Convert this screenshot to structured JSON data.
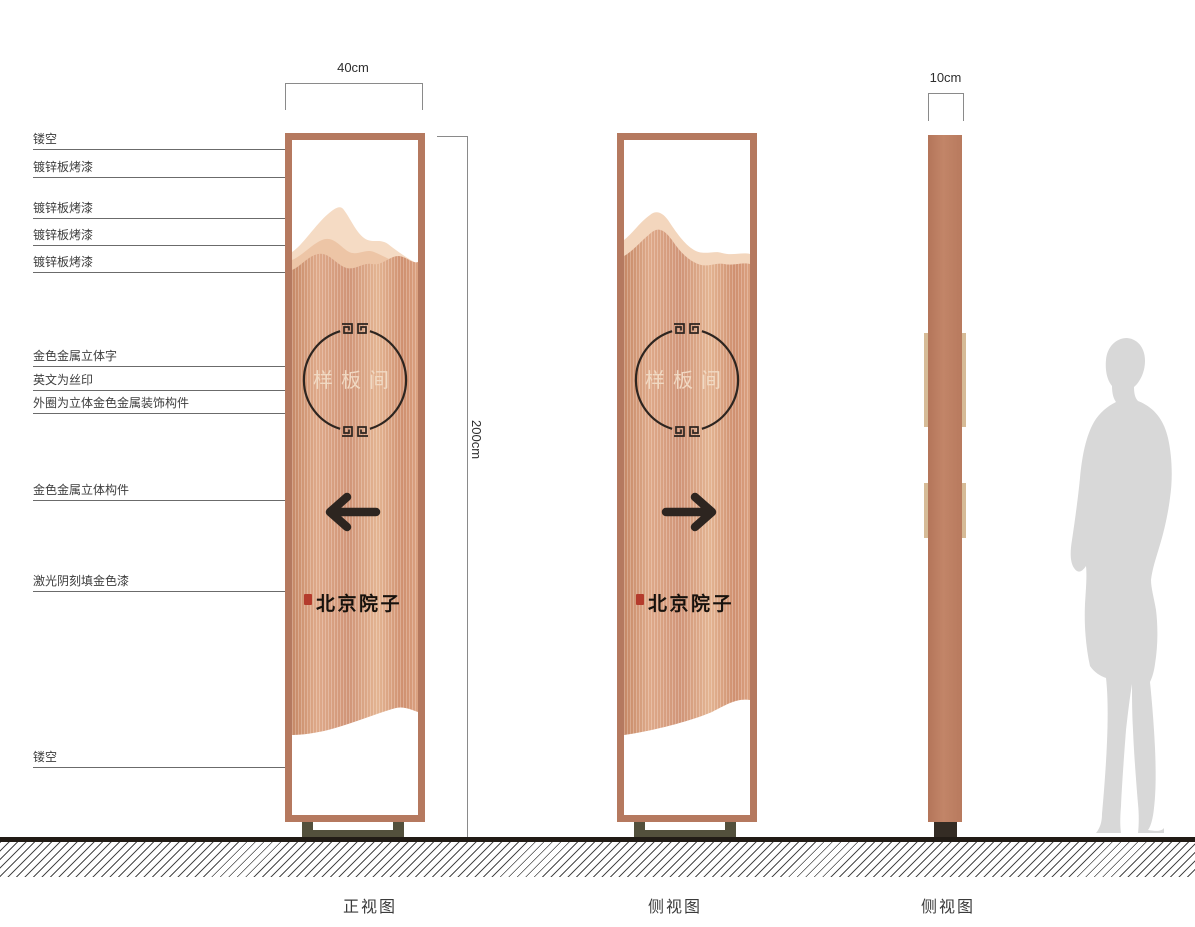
{
  "drawing": {
    "callouts": [
      "镂空",
      "镀锌板烤漆",
      "镀锌板烤漆",
      "镀锌板烤漆",
      "镀锌板烤漆",
      "金色金属立体字",
      "英文为丝印",
      "外圈为立体金色金属装饰构件",
      "金色金属立体构件",
      "激光阴刻填金色漆",
      "镂空"
    ],
    "dimensions": {
      "front_width": "40cm",
      "height": "200cm",
      "side_width": "10cm"
    },
    "sign": {
      "emblem_text": "样板间",
      "brand_text": "北京院子"
    },
    "view_labels": [
      "正视图",
      "侧视图",
      "侧视图"
    ],
    "colors": {
      "frame": "#b5795f",
      "copper_mid": "#d3977a",
      "copper_light": "#f5dbc4",
      "accent_dark": "#2d2520",
      "seal_red": "#b43b2c",
      "stand": "#53503c",
      "silhouette": "#d8d8d8"
    }
  }
}
